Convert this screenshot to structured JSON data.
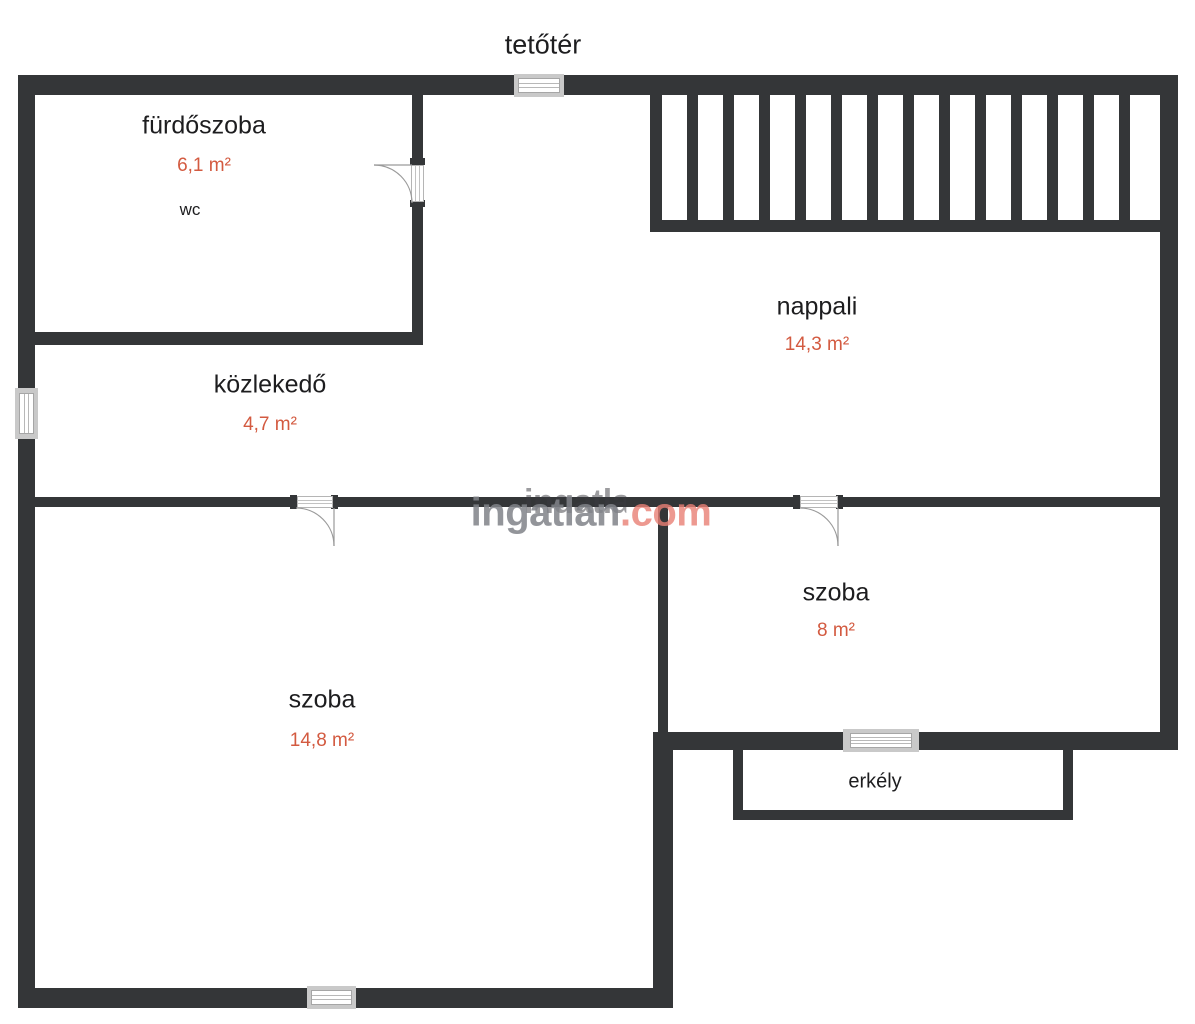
{
  "floor": {
    "title": "tetőtér"
  },
  "rooms": [
    {
      "name": "fürdőszoba",
      "area": "6,1 m²",
      "extra": "wc"
    },
    {
      "name": "közlekedő",
      "area": "4,7 m²"
    },
    {
      "name": "nappali",
      "area": "14,3 m²"
    },
    {
      "name": "szoba",
      "area": "14,8 m²"
    },
    {
      "name": "szoba",
      "area": "8 m²"
    },
    {
      "name": "erkély"
    }
  ],
  "watermark": {
    "brand": "ingatlan",
    "tld": ".com"
  },
  "colors": {
    "wall": "#343638",
    "room_label": "#1d1d1f",
    "area_text": "#d35a40",
    "watermark_brand": "#808388",
    "watermark_tld": "#e98074",
    "window_frame": "#c9c9c9",
    "background": "#ffffff"
  }
}
